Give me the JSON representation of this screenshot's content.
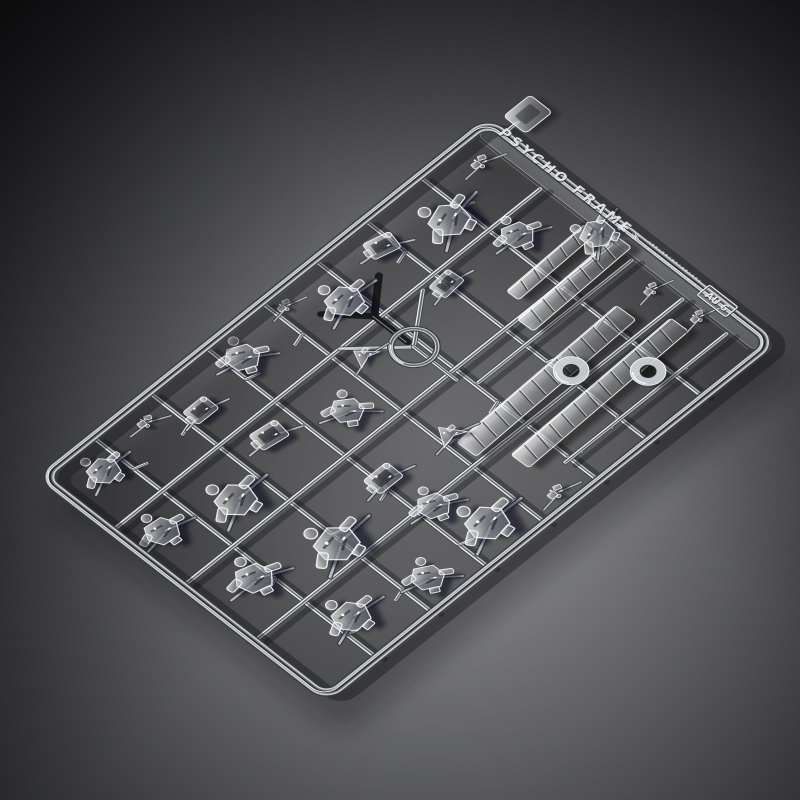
{
  "figure": {
    "description": "Studio product photograph of a transparent injection-molded plastic model-kit runner (sprue) holding many clear mecha parts, lit on a gray gradient background"
  },
  "colors": {
    "bg_center": "#97989b",
    "bg_mid": "#57585b",
    "bg_edge": "#121316",
    "glass_light": "#cbcfd4",
    "glass_white": "#ffffff",
    "glass_dark": "#383b40",
    "cast_shadow": "#0b0c0e",
    "emboss_text": "#e6e9ec"
  },
  "sprue": {
    "matrix": [
      0.7812,
      -0.6239,
      0.7893,
      0.6133,
      30,
      477
    ],
    "frame": {
      "x": 8,
      "y": 8,
      "w": 570,
      "h": 360,
      "rx": 16
    },
    "v_bars": [
      72,
      144,
      216,
      288,
      356,
      420,
      490
    ],
    "h_bars": [
      96,
      186,
      276
    ],
    "stub_ys": [
      60,
      240,
      330
    ],
    "strips": [
      {
        "x1": 360,
        "y1": 212,
        "x2": 556,
        "y2": 212
      },
      {
        "x1": 350,
        "y1": 332,
        "x2": 556,
        "y2": 332
      }
    ],
    "blades": [
      {
        "x": 298,
        "y": 258,
        "len": 212,
        "h": 24,
        "ribs": 13,
        "rot": -2
      },
      {
        "x": 322,
        "y": 302,
        "len": 212,
        "h": 22,
        "ribs": 13,
        "rot": -2
      },
      {
        "x": 436,
        "y": 196,
        "len": 130,
        "h": 20,
        "ribs": 8,
        "rot": -2
      },
      {
        "x": 452,
        "y": 164,
        "len": 104,
        "h": 15,
        "ribs": 6,
        "rot": -2
      }
    ],
    "donuts": [
      {
        "x": 428,
        "y": 262,
        "r": 16
      },
      {
        "x": 476,
        "y": 312,
        "r": 16
      }
    ],
    "gate": {
      "x": 348,
      "y": 142,
      "r": 21
    },
    "tab": {
      "x": 592,
      "y": 14,
      "w": 34,
      "h": 28
    },
    "clusters": [
      {
        "x": 52,
        "y": 42,
        "s": 1.0,
        "r": -15,
        "v": "A"
      },
      {
        "x": 118,
        "y": 30,
        "s": 0.75,
        "r": 10,
        "v": "D"
      },
      {
        "x": 162,
        "y": 56,
        "s": 0.9,
        "r": 0,
        "v": "B"
      },
      {
        "x": 232,
        "y": 40,
        "s": 1.05,
        "r": 20,
        "v": "A"
      },
      {
        "x": 300,
        "y": 26,
        "s": 0.7,
        "r": 0,
        "v": "D"
      },
      {
        "x": 342,
        "y": 60,
        "s": 1.15,
        "r": -12,
        "v": "A"
      },
      {
        "x": 410,
        "y": 40,
        "s": 0.95,
        "r": 14,
        "v": "B"
      },
      {
        "x": 474,
        "y": 62,
        "s": 1.25,
        "r": -25,
        "v": "A"
      },
      {
        "x": 540,
        "y": 36,
        "s": 0.8,
        "r": 5,
        "v": "D"
      },
      {
        "x": 40,
        "y": 128,
        "s": 1.05,
        "r": 0,
        "v": "A"
      },
      {
        "x": 112,
        "y": 150,
        "s": 1.25,
        "r": -18,
        "v": "A"
      },
      {
        "x": 185,
        "y": 120,
        "s": 1.0,
        "r": 8,
        "v": "B"
      },
      {
        "x": 255,
        "y": 150,
        "s": 1.0,
        "r": 30,
        "v": "A"
      },
      {
        "x": 310,
        "y": 118,
        "s": 0.8,
        "r": -8,
        "v": "C"
      },
      {
        "x": 420,
        "y": 112,
        "s": 0.9,
        "r": -5,
        "v": "B"
      },
      {
        "x": 505,
        "y": 118,
        "s": 1.0,
        "r": 12,
        "v": "A"
      },
      {
        "x": 556,
        "y": 168,
        "s": 1.05,
        "r": -30,
        "v": "A"
      },
      {
        "x": 60,
        "y": 225,
        "s": 1.15,
        "r": 10,
        "v": "A"
      },
      {
        "x": 140,
        "y": 250,
        "s": 1.35,
        "r": -20,
        "v": "A"
      },
      {
        "x": 222,
        "y": 228,
        "s": 1.0,
        "r": 0,
        "v": "B"
      },
      {
        "x": 232,
        "y": 282,
        "s": 1.0,
        "r": 15,
        "v": "A"
      },
      {
        "x": 300,
        "y": 236,
        "s": 0.9,
        "r": 0,
        "v": "C"
      },
      {
        "x": 90,
        "y": 318,
        "s": 1.15,
        "r": -10,
        "v": "A"
      },
      {
        "x": 170,
        "y": 336,
        "s": 1.0,
        "r": 25,
        "v": "A"
      },
      {
        "x": 252,
        "y": 330,
        "s": 1.3,
        "r": -15,
        "v": "A"
      },
      {
        "x": 320,
        "y": 350,
        "s": 0.8,
        "r": 0,
        "v": "D"
      },
      {
        "x": 545,
        "y": 248,
        "s": 0.7,
        "r": 0,
        "v": "D"
      },
      {
        "x": 552,
        "y": 300,
        "s": 0.7,
        "r": 0,
        "v": "D"
      }
    ],
    "markings": {
      "brand": "PSYCHO FRAME",
      "symbol1": "◈",
      "symbol2": "✳",
      "code": "AU 6"
    }
  }
}
